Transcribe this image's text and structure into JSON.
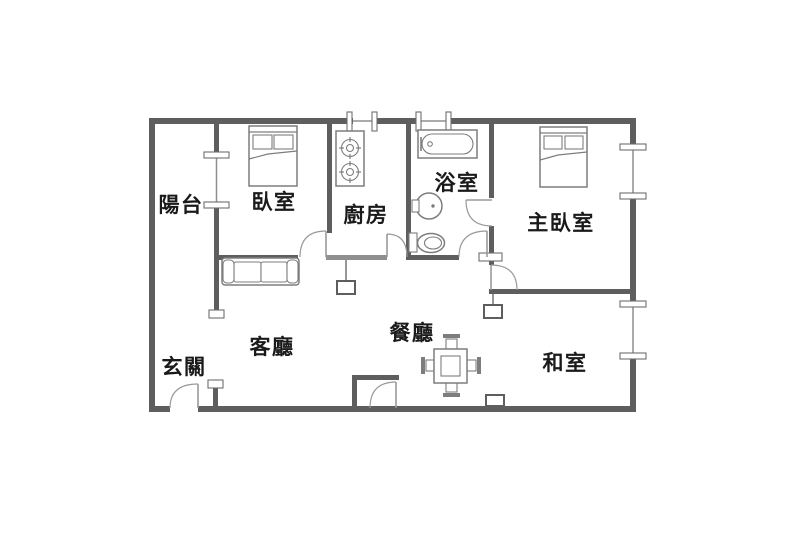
{
  "type": "floor-plan",
  "colors": {
    "wall": "#5e5e5e",
    "wall_light": "#8f8f8f",
    "line": "#7d7d7d",
    "arc": "#9a9a9a",
    "text": "#1a1a1a",
    "bg": "#ffffff"
  },
  "rooms": {
    "balcony": {
      "label": "陽台"
    },
    "bedroom": {
      "label": "臥室"
    },
    "kitchen": {
      "label": "廚房"
    },
    "bathroom": {
      "label": "浴室"
    },
    "master_bedroom": {
      "label": "主臥室"
    },
    "living_room": {
      "label": "客廳"
    },
    "dining_room": {
      "label": "餐廳"
    },
    "entryway": {
      "label": "玄關"
    },
    "tatami_room": {
      "label": "和室"
    }
  },
  "fixtures": [
    "single-bed",
    "double-bed",
    "gas-stove",
    "bathtub",
    "washbasin",
    "toilet",
    "sofa",
    "dining-table-with-chairs",
    "closet"
  ]
}
